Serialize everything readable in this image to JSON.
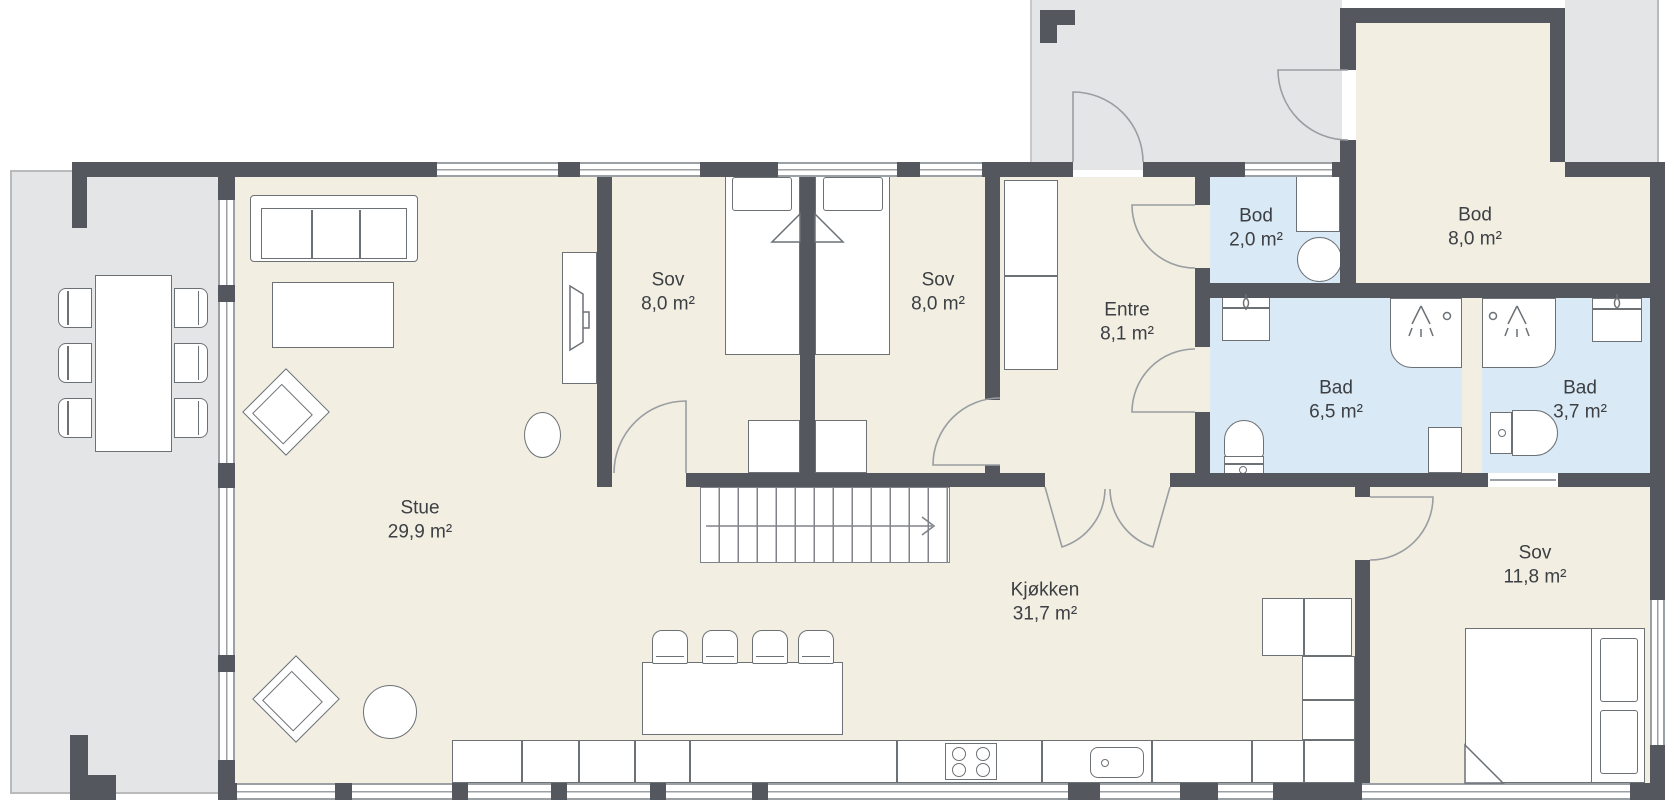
{
  "plan_title": "Floor plan",
  "rooms": [
    {
      "id": "stue",
      "name": "Stue",
      "area": "29,9 m²"
    },
    {
      "id": "sov-1",
      "name": "Sov",
      "area": "8,0 m²"
    },
    {
      "id": "sov-2",
      "name": "Sov",
      "area": "8,0 m²"
    },
    {
      "id": "entre",
      "name": "Entre",
      "area": "8,1 m²"
    },
    {
      "id": "bod-small",
      "name": "Bod",
      "area": "2,0 m²"
    },
    {
      "id": "bod-large",
      "name": "Bod",
      "area": "8,0 m²"
    },
    {
      "id": "bad-large",
      "name": "Bad",
      "area": "6,5 m²"
    },
    {
      "id": "bad-small",
      "name": "Bad",
      "area": "3,7 m²"
    },
    {
      "id": "sov-3",
      "name": "Sov",
      "area": "11,8 m²"
    },
    {
      "id": "kjokken",
      "name": "Kjøkken",
      "area": "31,7 m²"
    }
  ],
  "stairs": {
    "arrow_direction": "right"
  },
  "colors": {
    "wall": "#54585e",
    "interior_floor": "#f2eee2",
    "wet_room_floor": "#d9e9f5",
    "outdoor": "#e4e5e6",
    "furniture_stroke": "#6c7176",
    "label_text": "#3c3f43"
  }
}
